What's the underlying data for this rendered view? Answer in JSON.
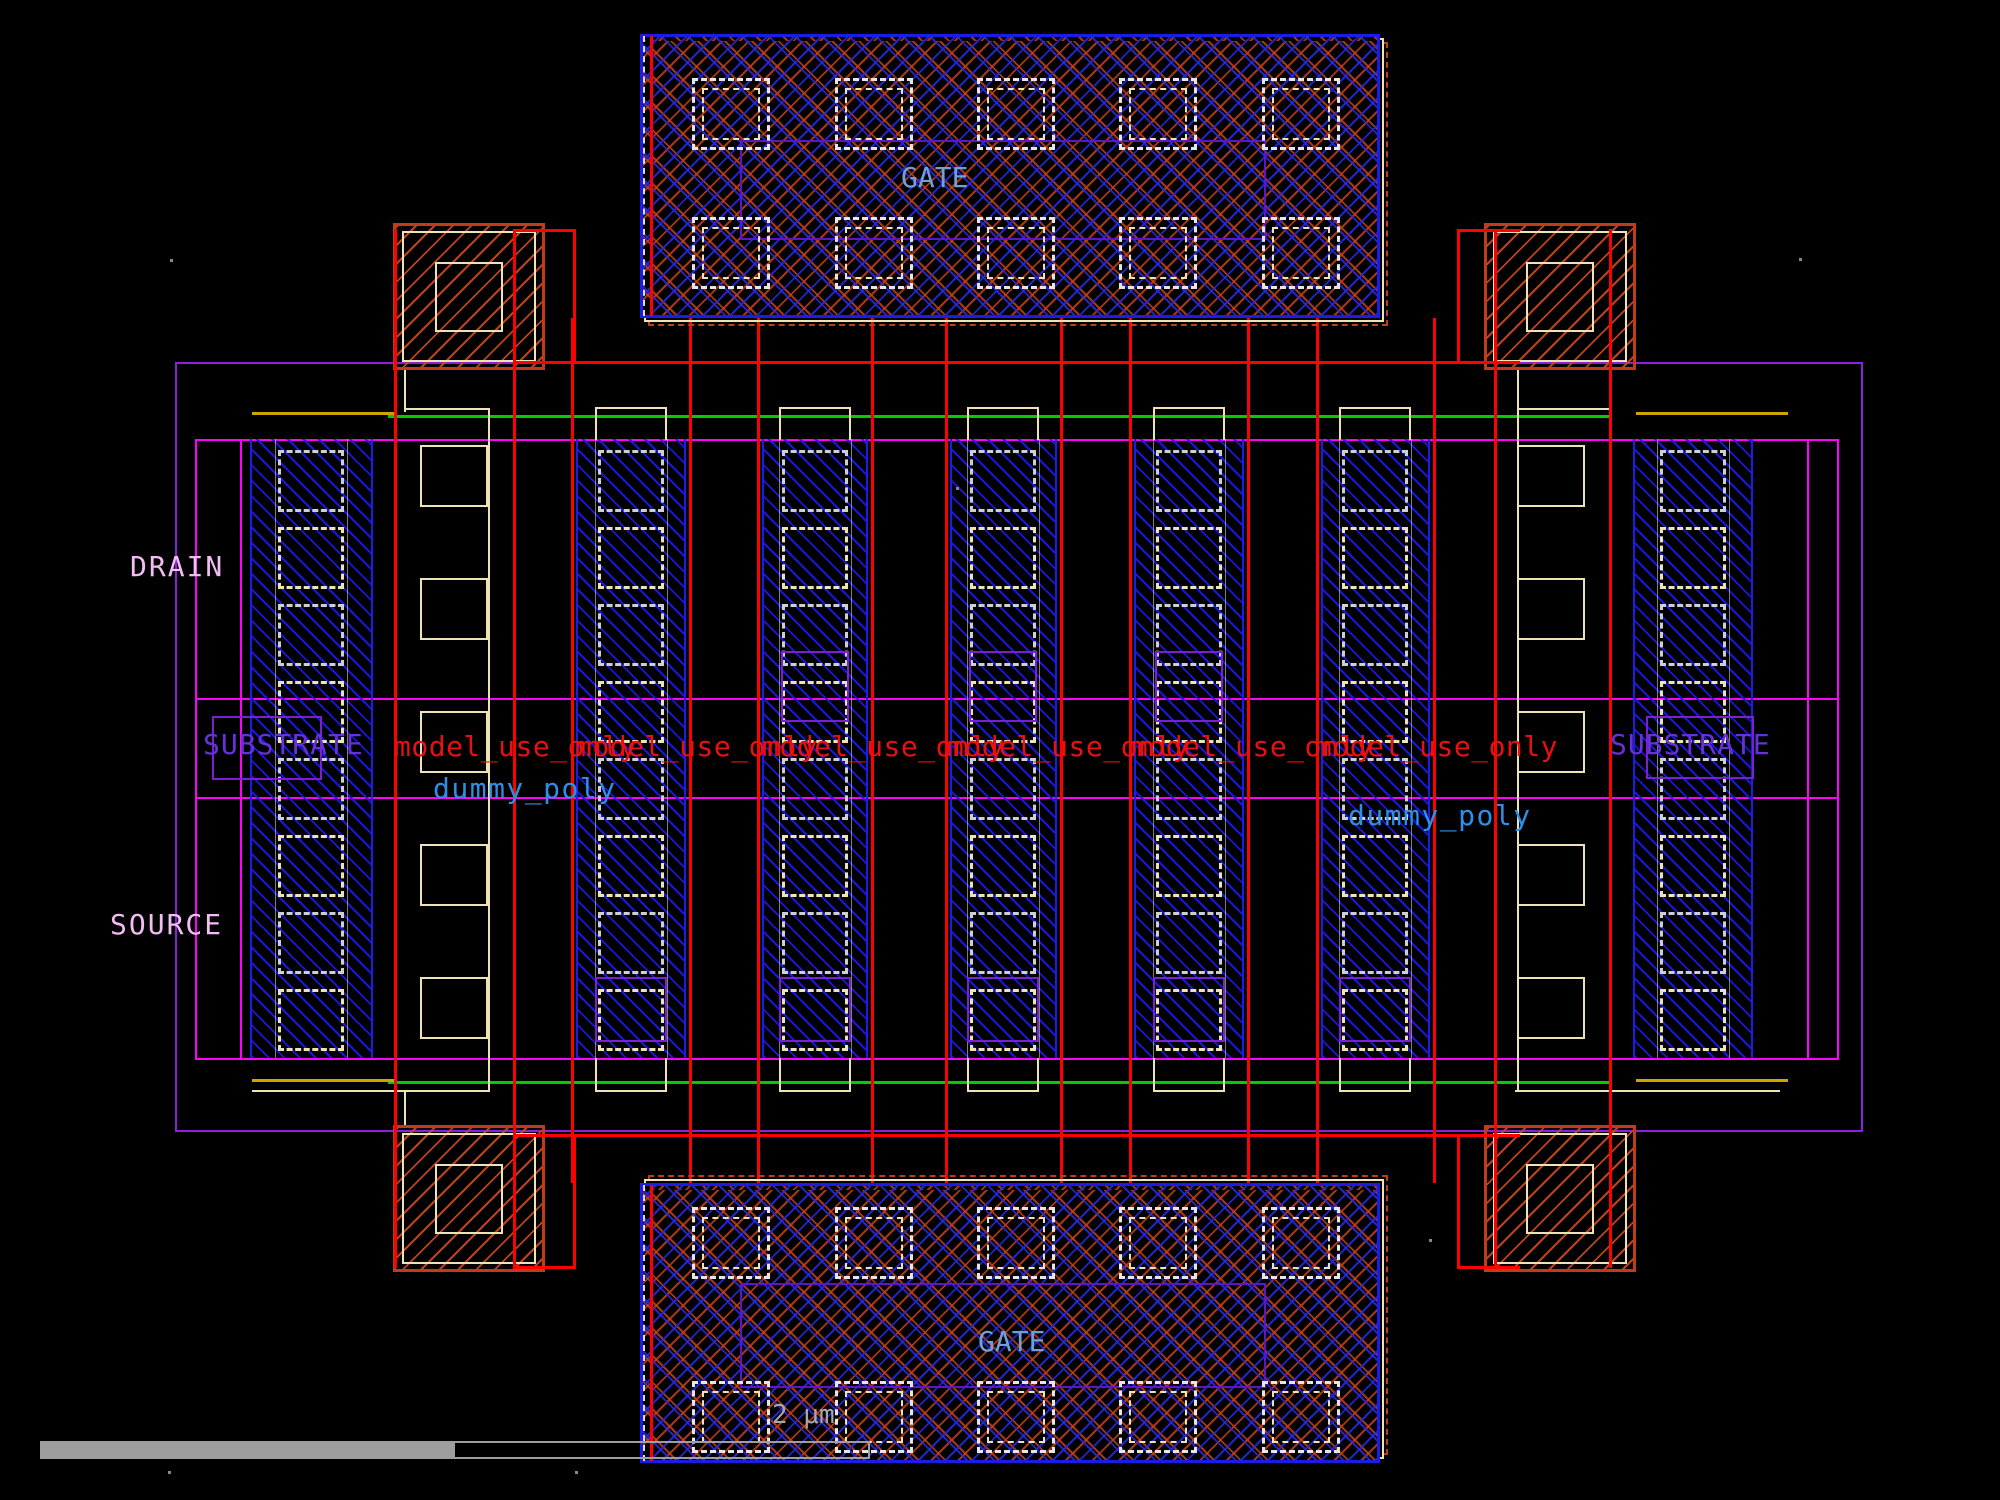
{
  "labels": {
    "gate_top": "GATE",
    "gate_bottom": "GATE",
    "drain": "DRAIN",
    "source": "SOURCE",
    "substrate_left": "SUBSTRATE",
    "substrate_right": "SUBSTRATE",
    "dummy_poly_left": "dummy_poly",
    "dummy_poly_right": "dummy_poly",
    "model_use_only": "model_use_only",
    "scale": "2 μm"
  },
  "model_use_instance_count": 6,
  "colors": {
    "background": "#000000",
    "metal_blue": "#1C1CE8",
    "hatch_blue": "#1919E6",
    "poly_red": "#FF0000",
    "well_magenta": "#FF00FF",
    "boundary_purple": "#8A22DD",
    "marker_purple": "#7A1FD4",
    "gate_label_purple": "#5F14C8",
    "active_green": "#00CC00",
    "rail_yellow": "#CFA400",
    "pad_orange": "#BE3C19",
    "contact_beige": "#EDE3B5",
    "contact_gray": "#CFCFCF",
    "text_pink": "#F4BCF4",
    "text_violet": "#6432D8",
    "text_red": "#E81010",
    "text_blue": "#2E8FE8",
    "text_steelblue": "#6FA0D8",
    "scalebar_gray": "#9E9E9E"
  }
}
